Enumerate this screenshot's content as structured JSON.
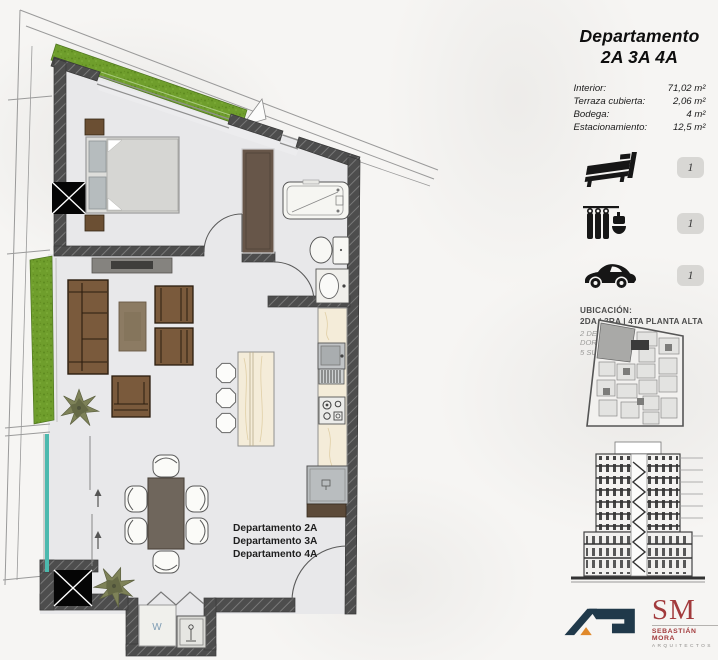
{
  "panel": {
    "title_line1": "Departamento",
    "title_line2": "2A 3A 4A",
    "areas": [
      {
        "label": "Interior:",
        "value": "71,02 m²"
      },
      {
        "label": "Terraza cubierta:",
        "value": "2,06 m²"
      },
      {
        "label": "Bodega:",
        "value": "4 m²"
      },
      {
        "label": "Estacionamiento:",
        "value": "12,5 m²"
      }
    ],
    "amenities": [
      {
        "icon": "bed-icon",
        "count": "1"
      },
      {
        "icon": "shower-icon",
        "count": "1"
      },
      {
        "icon": "car-icon",
        "count": "1"
      }
    ],
    "ubicacion": {
      "heading": "UBICACIÓN:",
      "line1": "2DA | 3RA | 4TA PLANTA ALTA",
      "line2": "2 DEPARTAMENTOS (2 DORMITORIOS) |",
      "line3": "5 SUITES |"
    },
    "logos": {
      "sm": "SM",
      "sm_name": "SEBASTIÁN MORA",
      "sm_sub": "ARQUITECTOS"
    }
  },
  "plan": {
    "unit_labels": [
      "Departamento 2A",
      "Departamento 3A",
      "Departamento 4A"
    ],
    "washer_label": "W"
  },
  "colors": {
    "wall": "#4d4d4d",
    "floor": "#e8e8ea",
    "grass": "#6f9e2c",
    "wood_brown": "#7a5a3c",
    "counter_cream": "#f4ecd9",
    "glass_teal": "#4cb9ae",
    "badge_gray": "#d8d7d4",
    "logo_navy": "#20394a",
    "logo_orange": "#e0892b",
    "logo_red": "#a23a3c"
  }
}
